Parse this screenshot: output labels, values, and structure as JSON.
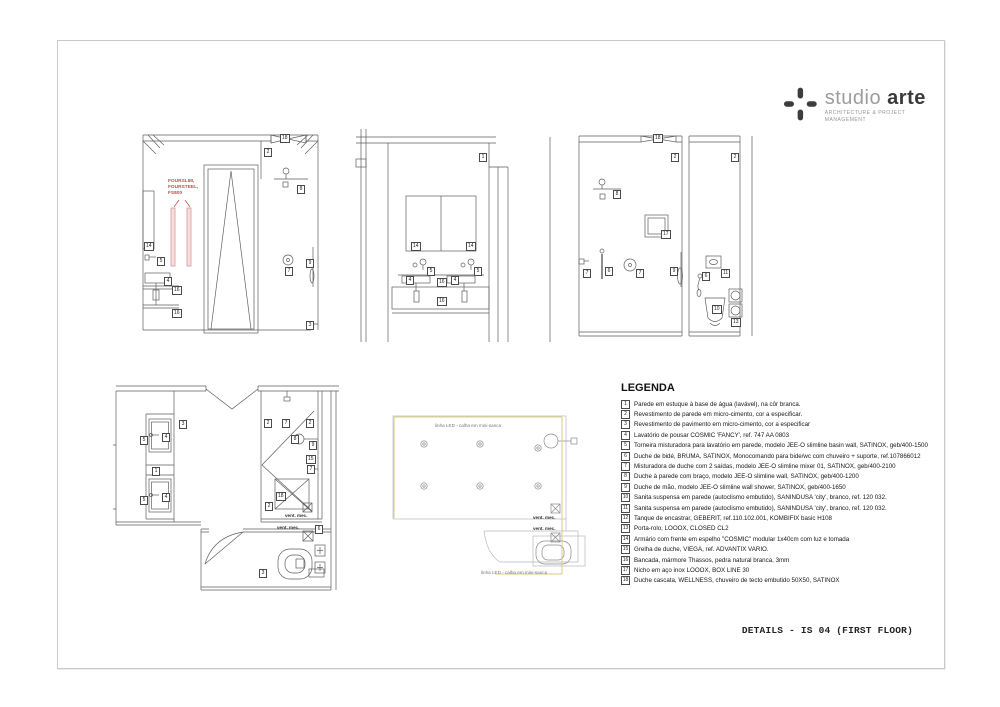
{
  "logo": {
    "brand_light": "studio",
    "brand_bold": "arte",
    "subtitle": "ARCHITECTURE & PROJECT MANAGEMENT"
  },
  "title_block": {
    "title": "DETAILS - IS 04 (FIRST FLOOR)"
  },
  "annotations": {
    "fourslim": "FOURSLIM,\nFOURSTEEL,\nFS800",
    "led_line": "linha LED - calha em mini-sanca",
    "vent": "vent. mec."
  },
  "colors": {
    "accent_red": "#c0504d",
    "led_yellow": "#d8ce82",
    "line_dark": "#5f5f5f",
    "line_light": "#b8b8b8"
  },
  "legend": {
    "title": "LEGENDA",
    "items": [
      {
        "n": "1",
        "t": "Parede em estuque à base de água (lavável), na côr branca."
      },
      {
        "n": "2",
        "t": "Revestimento de parede em micro-cimento, cor a especificar."
      },
      {
        "n": "3",
        "t": "Revestimento de pavimento em micro-cimento, cor a especificar"
      },
      {
        "n": "4",
        "t": "Lavatório de pousar COSMIC 'FANCY', ref. 747 AA 0803"
      },
      {
        "n": "5",
        "t": "Torneira misturadora para lavatório em parede, modelo JEE-O slimline basin wall, SATINOX, geb/400-1500"
      },
      {
        "n": "6",
        "t": "Duche de bidé, BRUMA, SATINOX, Monocomando para bide/wc com chuveiro + suporte, ref.107866012"
      },
      {
        "n": "7",
        "t": "Misturadora de duche com 2 saídas, modelo JEE-O slimline mixer 01, SATINOX, geb/400-2100"
      },
      {
        "n": "8",
        "t": "Duche à parede com braço, modelo JEE-O slimline wall, SATINOX, geb/400-1200"
      },
      {
        "n": "9",
        "t": "Duche de mão, modelo JEE-O slimline wall shower, SATINOX, geb/400-1650"
      },
      {
        "n": "10",
        "t": "Sanita suspensa em parede (autoclismo embutido), SANINDUSA 'city', branco, ref. 120 032."
      },
      {
        "n": "11",
        "t": "Sanita suspensa em parede (autoclismo embutido), SANINDUSA 'city', branco, ref. 120 032."
      },
      {
        "n": "12",
        "t": "Tanque de encastrar, GEBERIT, ref.110.102.001, KOMBIFIX basic H108"
      },
      {
        "n": "13",
        "t": "Porta-rolo, LOOOX, CLOSED CL2"
      },
      {
        "n": "14",
        "t": "Armário com frente em espelho \"COSMIC\" modular 1x40cm com luz e tomada"
      },
      {
        "n": "15",
        "t": "Grelha de duche, VIEGA, ref. ADVANTIX VARIO."
      },
      {
        "n": "16",
        "t": "Bancada, mármore Thassos, pedra natural branca, 3mm"
      },
      {
        "n": "17",
        "t": "Nicho em aço inox LOOOX, BOX LINE 30"
      },
      {
        "n": "18",
        "t": "Duche cascata, WELLNESS, chuveiro de tecto embutido 50X50, SATINOX"
      }
    ]
  },
  "drawings": {
    "d1": {
      "callouts": [
        "2",
        "18",
        "14",
        "5",
        "4",
        "16",
        "16",
        "8",
        "7",
        "9",
        "3"
      ]
    },
    "d2": {
      "callouts": [
        "1",
        "14",
        "14",
        "5",
        "5",
        "4",
        "16",
        "4",
        "16"
      ]
    },
    "d3": {
      "callouts": [
        "18",
        "2",
        "8",
        "17",
        "7",
        "6",
        "7",
        "9",
        "2",
        "11",
        "6",
        "10",
        "13"
      ]
    },
    "d4": {
      "callouts": [
        "4",
        "5",
        "1",
        "4",
        "5",
        "3",
        "2",
        "7",
        "2",
        "8",
        "9",
        "15",
        "7",
        "18",
        "2",
        "3",
        "6"
      ]
    }
  }
}
